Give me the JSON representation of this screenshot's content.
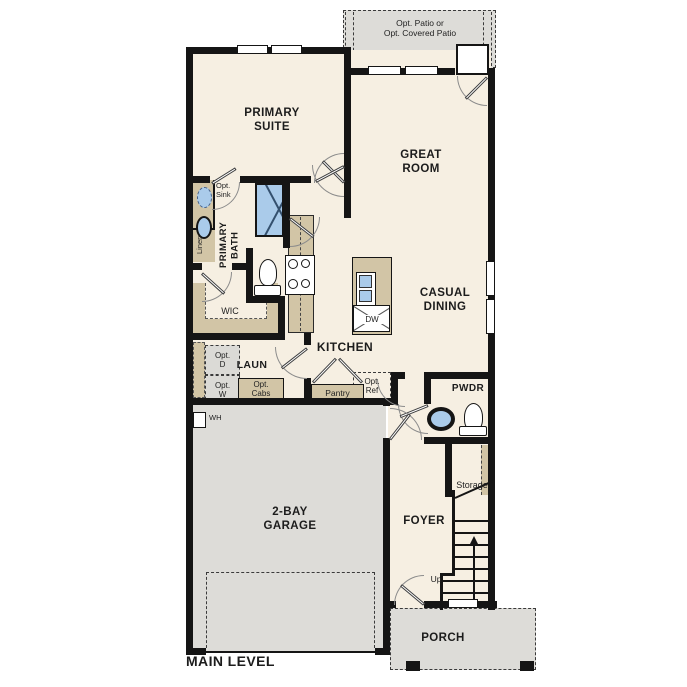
{
  "plan": {
    "title": "MAIN LEVEL",
    "rooms": {
      "patio": "Opt. Patio or\nOpt. Covered Patio",
      "primary_suite": "PRIMARY\nSUITE",
      "great_room": "GREAT\nROOM",
      "primary_bath": "PRIMARY\nBATH",
      "wic": "WIC",
      "casual_dining": "CASUAL\nDINING",
      "kitchen": "KITCHEN",
      "laundry": "LAUN",
      "powder": "PWDR",
      "foyer": "FOYER",
      "garage": "2-BAY\nGARAGE",
      "porch": "PORCH",
      "storage": "Storage"
    },
    "features": {
      "opt_sink": "Opt.\nSink",
      "linen": "Linen",
      "opt_dryer": "Opt.\nD",
      "opt_washer": "Opt.\nW",
      "opt_cabs": "Opt.\nCabs",
      "pantry": "Pantry",
      "opt_ref": "Opt.\nRef",
      "dishwasher": "DW",
      "water_heater": "WH",
      "stairs_up": "Up"
    },
    "colors": {
      "floor": "#f6efe2",
      "concrete": "#dddcd8",
      "cabinetry": "#d2c5a6",
      "fixture_blue": "#aacbea",
      "wall": "#151515"
    }
  }
}
